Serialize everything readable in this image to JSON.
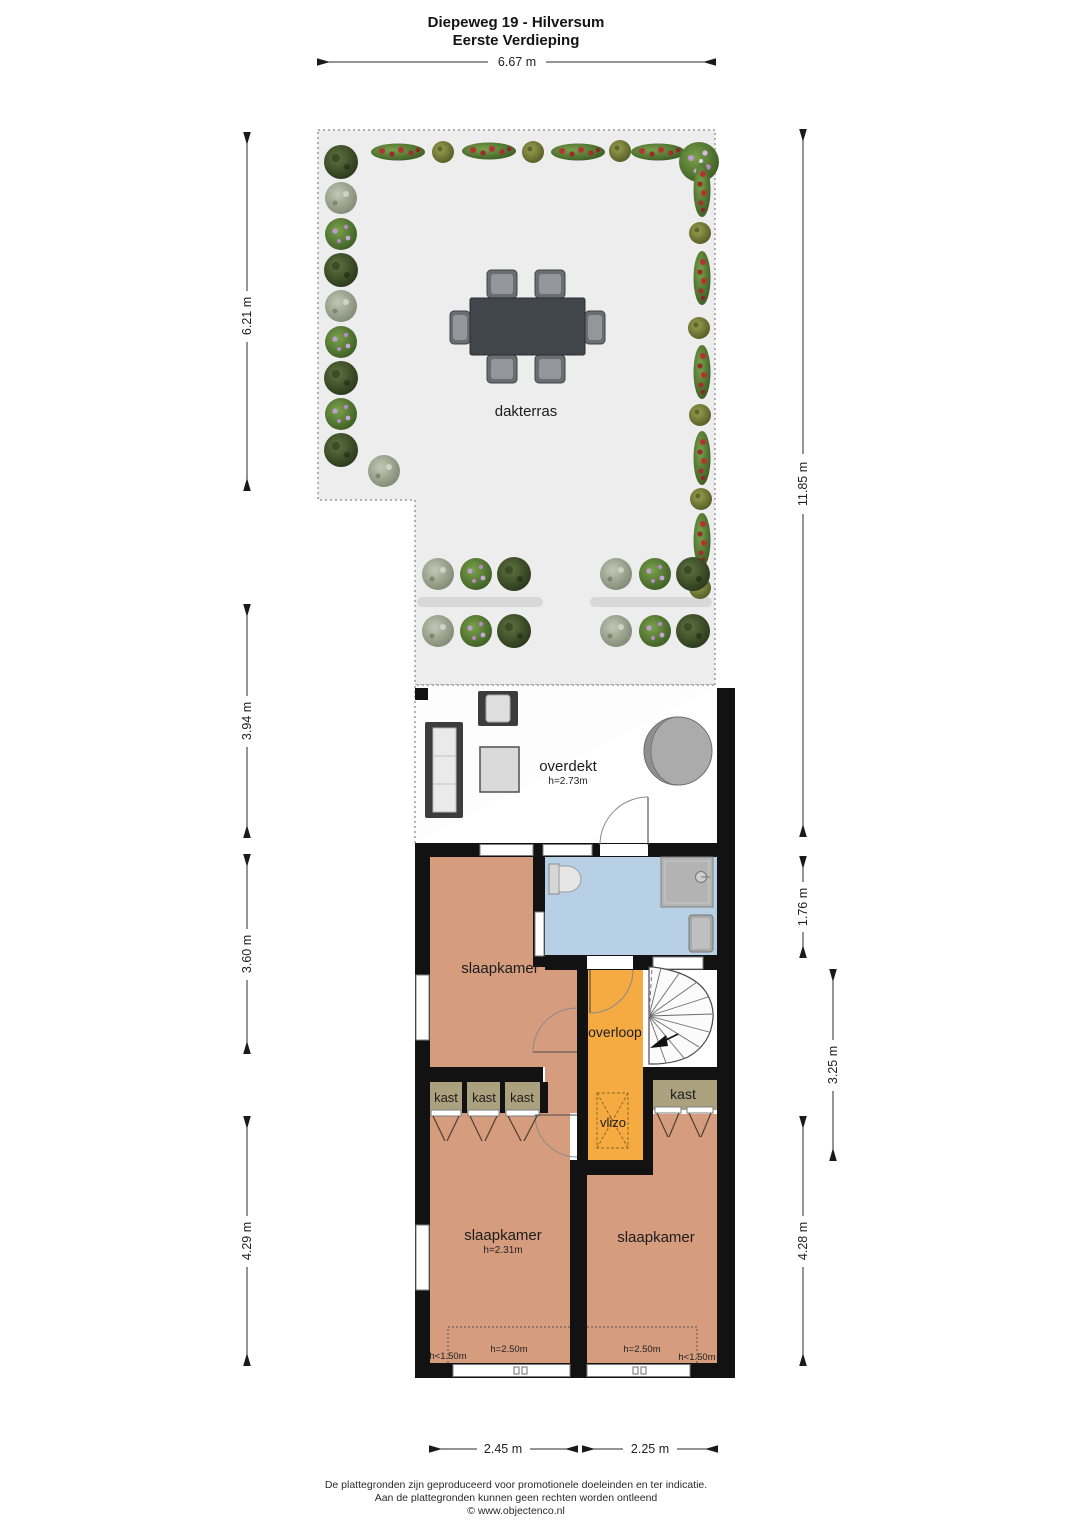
{
  "title": {
    "line1": "Diepeweg 19 - Hilversum",
    "line2": "Eerste Verdieping"
  },
  "dimensions": {
    "top": "6.67 m",
    "left": [
      "6.21 m",
      "3.94 m",
      "3.60 m",
      "4.29 m"
    ],
    "right": [
      "11.85 m",
      "1.76 m",
      "3.25 m",
      "4.28 m"
    ],
    "bottom": [
      "2.45 m",
      "2.25 m"
    ]
  },
  "rooms": {
    "dakterras": "dakterras",
    "overdekt": {
      "name": "overdekt",
      "height": "h=2.73m"
    },
    "slaapkamer_mid": "slaapkamer",
    "overloop": "overloop",
    "vlizo": "vlizo",
    "kast1": "kast",
    "kast2": "kast",
    "kast3": "kast",
    "kast_right": "kast",
    "slaapkamer_left": {
      "name": "slaapkamer",
      "height": "h=2.31m"
    },
    "slaapkamer_right": "slaapkamer",
    "height_zones": {
      "left_low": "h<1.50m",
      "left_mid": "h=2.50m",
      "right_mid": "h=2.50m",
      "right_low": "h<1.50m"
    }
  },
  "footer": {
    "line1": "De plattegronden zijn geproduceerd voor promotionele doeleinden en ter indicatie.",
    "line2": "Aan de plattegronden kunnen geen rechten worden ontleend",
    "line3": "© www.objectenco.nl"
  },
  "colors": {
    "wall": "#121212",
    "bedroom": "#d69c7e",
    "bathroom": "#b7d0e6",
    "hallway": "#f6ab42",
    "closet": "#aca17e",
    "terrace": "#ededed",
    "stairs": "#ffffff"
  }
}
